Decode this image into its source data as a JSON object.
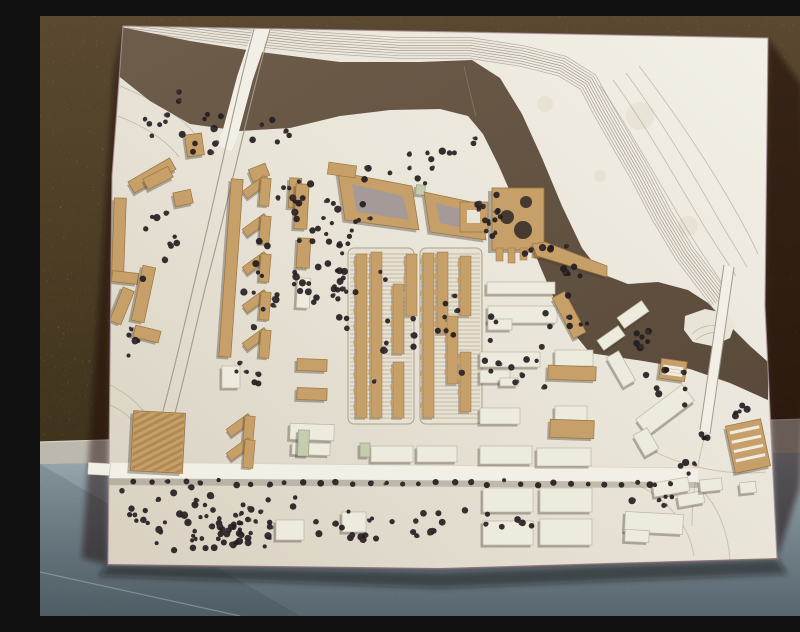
{
  "scene": {
    "colors": {
      "wall_top": "#5a4930",
      "wall_mid": "#483a22",
      "wall_bottom": "#342a16",
      "cork_light": "#8a734a",
      "cork_dark": "#1f180c",
      "baseboard": "#bdb8ad",
      "baseboard_hi": "#d6d2c8",
      "baseboard_lo": "#7f7b73",
      "floor_top": "#9aa9b0",
      "floor_bottom": "#72838c",
      "floor_seam": "#a8b9bf",
      "board_dark": "#d8d1c1",
      "board": "#e9e4d8",
      "board_light": "#f3f0e7",
      "edge_line": "#a98f9a",
      "edge_bottom": "#6b565e",
      "river_a": "#6e5d4a",
      "river_b": "#5a4a3b",
      "contour": "#94897c",
      "contour_faint": "#a79d8e",
      "ground_curve": "#c6b99f",
      "road": "#f2efe6",
      "road_edge": "#a29a8c",
      "road_hi": "#d9d3c5",
      "tan": "#c79f68",
      "tan_edge": "#97753f",
      "tan_stripe": "rgba(150,110,60,0.45)",
      "white_b": "#edeade",
      "white_edge": "#bdb5a5",
      "green_b": "#c6ccae",
      "court_inner": "#a59a98",
      "shadow": "rgba(70,60,50,0.38)",
      "cast": "rgba(15,10,6,0.5)",
      "tree": "#241d1f",
      "tree2": "#3a3133",
      "hatch_bg": "#e7e1d2",
      "hatch_line": "#bfb7a7",
      "hatch_edge": "#ab9f8d",
      "hole": "#453931",
      "stain": "#d8cfba",
      "stripe_white": "#efece2",
      "crack": "#8a7a66"
    },
    "board_outline": [
      [
        83,
        10
      ],
      [
        420,
        16
      ],
      [
        728,
        22
      ],
      [
        725,
        290
      ],
      [
        737,
        543
      ],
      [
        400,
        553
      ],
      [
        68,
        549
      ],
      [
        70,
        350
      ],
      [
        72,
        160
      ]
    ],
    "board_bottom": [
      [
        68,
        549
      ],
      [
        400,
        553
      ],
      [
        737,
        543
      ]
    ],
    "shadow_right": [
      [
        728,
        22
      ],
      [
        762,
        70
      ],
      [
        770,
        300
      ],
      [
        760,
        470
      ],
      [
        737,
        543
      ],
      [
        724,
        290
      ]
    ],
    "shadow_left": [
      [
        83,
        10
      ],
      [
        70,
        300
      ],
      [
        68,
        549
      ],
      [
        42,
        542
      ],
      [
        58,
        300
      ],
      [
        74,
        56
      ]
    ],
    "shadow_bottom": [
      [
        68,
        549
      ],
      [
        400,
        556
      ],
      [
        737,
        543
      ],
      [
        748,
        558
      ],
      [
        400,
        572
      ],
      [
        58,
        560
      ]
    ],
    "baseboard_poly": [
      [
        0,
        426
      ],
      [
        800,
        402
      ],
      [
        800,
        437
      ],
      [
        0,
        449
      ]
    ],
    "floor_poly": [
      [
        0,
        448
      ],
      [
        800,
        436
      ],
      [
        800,
        600
      ],
      [
        0,
        600
      ]
    ],
    "floor_corner": [
      [
        0,
        448
      ],
      [
        260,
        600
      ],
      [
        0,
        600
      ]
    ],
    "river": [
      [
        76,
        10
      ],
      [
        150,
        25
      ],
      [
        220,
        36
      ],
      [
        300,
        46
      ],
      [
        380,
        46
      ],
      [
        432,
        44
      ],
      [
        460,
        62
      ],
      [
        482,
        98
      ],
      [
        502,
        142
      ],
      [
        522,
        190
      ],
      [
        542,
        232
      ],
      [
        562,
        258
      ],
      [
        588,
        268
      ],
      [
        618,
        266
      ],
      [
        648,
        274
      ],
      [
        668,
        287
      ],
      [
        690,
        310
      ],
      [
        710,
        330
      ],
      [
        728,
        346
      ],
      [
        728,
        384
      ],
      [
        690,
        367
      ],
      [
        650,
        353
      ],
      [
        603,
        345
      ],
      [
        550,
        337
      ],
      [
        532,
        315
      ],
      [
        515,
        285
      ],
      [
        500,
        250
      ],
      [
        486,
        215
      ],
      [
        472,
        180
      ],
      [
        458,
        148
      ],
      [
        443,
        118
      ],
      [
        428,
        100
      ],
      [
        400,
        93
      ],
      [
        350,
        94
      ],
      [
        300,
        100
      ],
      [
        250,
        112
      ],
      [
        200,
        115
      ],
      [
        150,
        108
      ],
      [
        110,
        85
      ],
      [
        76,
        58
      ]
    ],
    "peninsula": [
      [
        645,
        300
      ],
      [
        665,
        293
      ],
      [
        685,
        297
      ],
      [
        695,
        308
      ],
      [
        690,
        322
      ],
      [
        672,
        330
      ],
      [
        653,
        326
      ],
      [
        644,
        314
      ]
    ],
    "peninsula_arcs": [
      "M 652,318 C 660,310 672,307 684,312",
      "M 656,324 C 664,317 674,315 683,318"
    ],
    "slope_band": {
      "base": [
        [
          88,
          4
        ],
        [
          180,
          16
        ],
        [
          270,
          26
        ],
        [
          360,
          32
        ],
        [
          430,
          32
        ],
        [
          482,
          40
        ],
        [
          522,
          50
        ],
        [
          548,
          66
        ],
        [
          562,
          92
        ],
        [
          578,
          120
        ],
        [
          600,
          158
        ],
        [
          622,
          200
        ],
        [
          645,
          238
        ],
        [
          668,
          268
        ],
        [
          680,
          284
        ]
      ],
      "lines": 9,
      "spacing": 2.6
    },
    "outer_arcs": [
      "M 560,70 C 585,105 615,160 648,215 C 660,235 672,252 684,270",
      "M 573,64 C 601,102 633,158 664,210 C 675,228 686,244 696,260",
      "M 586,57 C 617,99 651,154 679,204 C 689,221 699,237 707,251",
      "M 599,50 C 633,94 669,148 694,192 C 703,208 712,224 718,238"
    ],
    "city_contours": [
      "M 83,42 C 128,60 158,80 174,104",
      "M 80,70 C 118,86 143,101 157,121",
      "M 78,100 C 108,112 128,126 139,141",
      "M 68,388 C 94,399 108,420 112,447",
      "M 64,366 C 90,378 107,394 114,414"
    ],
    "ground_curves": [
      "M 580,462 C 618,474 648,502 654,540",
      "M 604,430 C 642,452 690,460 726,456",
      "M 660,472 C 680,492 688,518 690,544",
      "M 666,416 C 658,444 652,478 652,510"
    ],
    "crack": "M 424,50 C 428,68 432,86 436,100",
    "bridge_left": {
      "deck": "M 224,6 L 205,62 L 190,118 L 184,132",
      "edges": [
        "M 217,3 C 200,60 178,170 156,260 C 142,318 124,400 106,452",
        "M 232,7 C 214,66 190,180 167,265 C 153,320 136,405 117,455"
      ]
    },
    "bridge_right": {
      "deck": "M 689,250 L 665,416",
      "edges": [
        "M 684,249 L 660,414",
        "M 694,251 L 670,418"
      ]
    },
    "road": {
      "strip": [
        [
          50,
          446
        ],
        [
          658,
          452
        ],
        [
          658,
          466
        ],
        [
          50,
          462
        ]
      ],
      "under": [
        [
          50,
          462
        ],
        [
          658,
          466
        ],
        [
          658,
          472
        ],
        [
          50,
          469
        ]
      ],
      "topline": "M 50,446 L 658,452",
      "stub": [
        48,
        447,
        22,
        12
      ]
    },
    "hatch_blocks": [
      [
        308,
        232,
        66,
        176
      ],
      [
        380,
        232,
        62,
        176
      ]
    ],
    "hatch_slabs": [
      [
        316,
        238,
        11,
        164
      ],
      [
        331,
        236,
        11,
        166
      ],
      [
        353,
        268,
        11,
        70
      ],
      [
        366,
        238,
        11,
        62
      ],
      [
        353,
        346,
        11,
        56
      ],
      [
        383,
        237,
        11,
        165
      ],
      [
        397,
        236,
        11,
        82
      ],
      [
        407,
        300,
        11,
        68
      ],
      [
        420,
        240,
        11,
        60
      ],
      [
        420,
        336,
        11,
        60
      ]
    ],
    "tan_buildings": [
      [
        88,
        153,
        48,
        13,
        -30
      ],
      [
        73,
        182,
        12,
        76,
        2
      ],
      [
        72,
        256,
        26,
        11,
        6
      ],
      [
        76,
        272,
        12,
        36,
        22
      ],
      [
        97,
        250,
        13,
        56,
        12
      ],
      [
        94,
        312,
        26,
        12,
        14
      ],
      [
        104,
        156,
        28,
        12,
        -27
      ],
      [
        146,
        118,
        17,
        22,
        -8
      ],
      [
        134,
        175,
        18,
        14,
        -12
      ],
      [
        210,
        150,
        18,
        13,
        -22
      ],
      [
        185,
        163,
        12,
        178,
        4
      ],
      [
        249,
        162,
        12,
        30,
        3
      ],
      [
        255,
        168,
        13,
        45,
        3
      ],
      [
        257,
        222,
        13,
        30,
        3
      ],
      [
        522,
        276,
        14,
        46,
        -28
      ],
      [
        508,
        350,
        48,
        14,
        2
      ],
      [
        510,
        404,
        44,
        18,
        2
      ],
      [
        257,
        343,
        30,
        12,
        2
      ],
      [
        257,
        372,
        30,
        12,
        2
      ]
    ],
    "white_buildings": [
      [
        440,
        336,
        60,
        15,
        0
      ],
      [
        515,
        334,
        38,
        16,
        0
      ],
      [
        440,
        354,
        30,
        13,
        0
      ],
      [
        460,
        362,
        18,
        8,
        0
      ],
      [
        440,
        392,
        40,
        16,
        0
      ],
      [
        515,
        390,
        32,
        15,
        0
      ],
      [
        447,
        266,
        68,
        12,
        0
      ],
      [
        448,
        290,
        69,
        17,
        0
      ],
      [
        448,
        303,
        24,
        11,
        0
      ],
      [
        331,
        430,
        42,
        16,
        0
      ],
      [
        377,
        430,
        40,
        16,
        0
      ],
      [
        440,
        430,
        52,
        18,
        0
      ],
      [
        497,
        432,
        54,
        18,
        0
      ],
      [
        443,
        472,
        50,
        24,
        0
      ],
      [
        500,
        472,
        52,
        24,
        0
      ],
      [
        443,
        505,
        50,
        24,
        0
      ],
      [
        500,
        503,
        52,
        26,
        0
      ],
      [
        302,
        496,
        24,
        20,
        0
      ],
      [
        236,
        504,
        28,
        20,
        0
      ],
      [
        578,
        292,
        30,
        13,
        -35
      ],
      [
        558,
        316,
        26,
        12,
        -35
      ],
      [
        574,
        336,
        14,
        34,
        -30
      ],
      [
        596,
        384,
        58,
        20,
        -37
      ],
      [
        598,
        414,
        16,
        24,
        -30
      ],
      [
        613,
        464,
        36,
        14,
        -10
      ],
      [
        638,
        477,
        26,
        12,
        -10
      ],
      [
        585,
        497,
        58,
        20,
        3
      ],
      [
        585,
        514,
        24,
        12,
        3
      ],
      [
        660,
        463,
        22,
        12,
        -6
      ],
      [
        700,
        466,
        16,
        11,
        -6
      ],
      [
        250,
        408,
        44,
        16,
        2
      ],
      [
        252,
        427,
        38,
        12,
        2
      ],
      [
        182,
        350,
        18,
        22,
        0
      ],
      [
        257,
        262,
        13,
        30,
        3
      ]
    ],
    "green_buildings": [
      [
        376,
        169,
        9,
        10,
        5
      ],
      [
        258,
        414,
        11,
        26,
        2
      ],
      [
        320,
        427,
        10,
        14,
        0
      ]
    ],
    "chevrons": [
      [
        202,
        160
      ],
      [
        202,
        198
      ],
      [
        202,
        236
      ],
      [
        202,
        274
      ],
      [
        202,
        312
      ],
      [
        186,
        398
      ],
      [
        186,
        422
      ]
    ],
    "courtyards": [
      {
        "outer": [
          [
            298,
            156
          ],
          [
            372,
            170
          ],
          [
            379,
            214
          ],
          [
            305,
            204
          ]
        ],
        "inner": [
          [
            312,
            168
          ],
          [
            363,
            180
          ],
          [
            369,
            204
          ],
          [
            317,
            196
          ]
        ]
      },
      {
        "outer": [
          [
            384,
            176
          ],
          [
            441,
            188
          ],
          [
            446,
            224
          ],
          [
            390,
            216
          ]
        ],
        "inner": [
          [
            396,
            187
          ],
          [
            433,
            196
          ],
          [
            437,
            215
          ],
          [
            400,
            207
          ]
        ]
      }
    ],
    "flag": [
      288,
      148,
      28,
      12,
      8
    ],
    "special": {
      "main": [
        452,
        172,
        52,
        62
      ],
      "holes": [
        [
          467,
          201,
          7
        ],
        [
          486,
          186,
          6
        ],
        [
          483,
          214,
          9
        ]
      ],
      "legs": [
        [
          456,
          232,
          7,
          13
        ],
        [
          468,
          232,
          7,
          15
        ],
        [
          480,
          232,
          7,
          12
        ],
        [
          492,
          232,
          7,
          10
        ]
      ],
      "ramp": [
        [
          492,
          228
        ],
        [
          505,
          226
        ],
        [
          567,
          250
        ],
        [
          567,
          261
        ],
        [
          497,
          240
        ]
      ],
      "court_rect": [
        420,
        186,
        28,
        30
      ],
      "court_hole": [
        427,
        194,
        13,
        13
      ]
    },
    "hall": [
      92,
      396,
      52,
      60,
      3
    ],
    "striped": [
      {
        "r": [
          690,
          406,
          36,
          48,
          -12
        ],
        "n": 4
      },
      {
        "r": [
          620,
          344,
          26,
          20,
          8
        ],
        "n": 3
      }
    ],
    "stains": [
      [
        600,
        100,
        14
      ],
      [
        648,
        210,
        10
      ],
      [
        505,
        88,
        8
      ],
      [
        560,
        160,
        6
      ]
    ],
    "floor_seam_path": "M 0,556 L 200,600",
    "trees": {
      "seed": 12,
      "clusters": [
        [
          150,
          100,
          60,
          38,
          13
        ],
        [
          360,
          160,
          75,
          28,
          10
        ],
        [
          230,
          120,
          35,
          20,
          6
        ],
        [
          420,
          130,
          30,
          18,
          5
        ],
        [
          445,
          195,
          22,
          28,
          7
        ],
        [
          508,
          232,
          28,
          12,
          6
        ],
        [
          532,
          256,
          22,
          9,
          5
        ],
        [
          450,
          190,
          16,
          40,
          7
        ],
        [
          300,
          262,
          16,
          78,
          26
        ],
        [
          272,
          195,
          20,
          42,
          12
        ],
        [
          268,
          270,
          20,
          45,
          10
        ],
        [
          225,
          262,
          26,
          72,
          12
        ],
        [
          248,
          180,
          14,
          30,
          6
        ],
        [
          320,
          200,
          30,
          18,
          6
        ],
        [
          115,
          228,
          38,
          55,
          10
        ],
        [
          95,
          320,
          12,
          30,
          5
        ],
        [
          350,
          300,
          30,
          70,
          9
        ],
        [
          410,
          320,
          22,
          60,
          8
        ],
        [
          480,
          352,
          46,
          58,
          13
        ],
        [
          524,
          300,
          26,
          26,
          7
        ],
        [
          600,
          320,
          24,
          22,
          6
        ],
        [
          625,
          365,
          33,
          32,
          9
        ],
        [
          700,
          395,
          17,
          15,
          5
        ],
        [
          210,
          360,
          20,
          25,
          6
        ],
        [
          185,
          505,
          78,
          36,
          46
        ],
        [
          205,
          516,
          46,
          22,
          20
        ],
        [
          310,
          515,
          36,
          25,
          13
        ],
        [
          382,
          505,
          46,
          30,
          10
        ],
        [
          95,
          505,
          18,
          38,
          8
        ],
        [
          470,
          508,
          30,
          24,
          6
        ],
        [
          610,
          480,
          25,
          16,
          6
        ],
        [
          645,
          452,
          16,
          10,
          4
        ],
        [
          672,
          425,
          14,
          10,
          4
        ],
        [
          162,
          133,
          18,
          10,
          4
        ]
      ],
      "row": {
        "x0": 95,
        "x1": 632,
        "y": 467,
        "n": 33
      }
    }
  }
}
